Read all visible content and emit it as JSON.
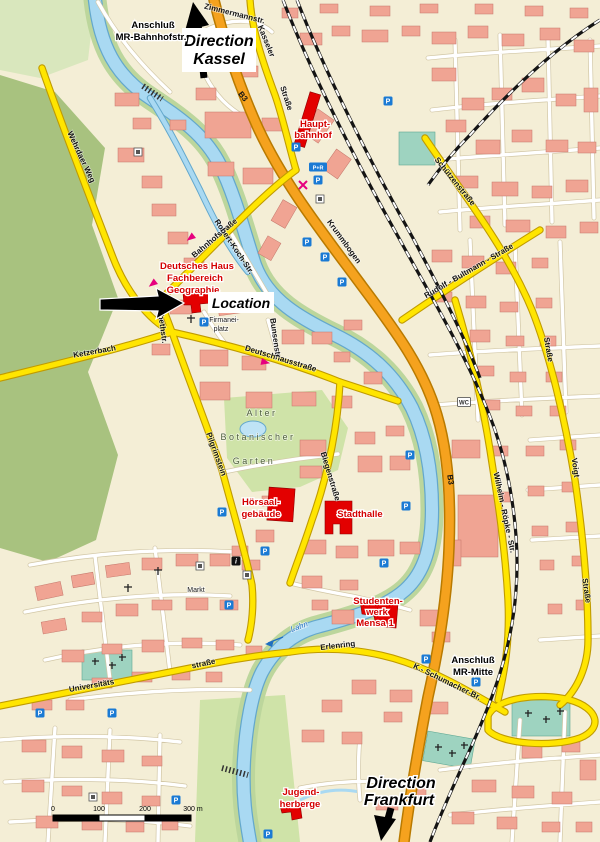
{
  "map": {
    "labels": {
      "direction_kassel": [
        "Direction",
        "Kassel"
      ],
      "direction_frankfurt": [
        "Direction",
        "Frankfurt"
      ],
      "anschluss_bahnhofstr": [
        "Anschluß",
        "MR-Bahnhofstr."
      ],
      "anschluss_mr_mitte": [
        "Anschluß",
        "MR-Mitte"
      ],
      "location": "Location"
    },
    "places": {
      "hauptbahnhof": [
        "Haupt-",
        "bahnhof"
      ],
      "deutsches_haus": [
        "Deutsches Haus",
        "Fachbereich",
        "Geographie"
      ],
      "firmaneiplatz": [
        "Firmanei-",
        "platz"
      ],
      "hoersaalgebaeude": [
        "Hörsaal-",
        "gebäude"
      ],
      "stadthalle": "Stadthalle",
      "studentenwerk_mensa": [
        "Studenten-",
        "werk",
        "Mensa 1"
      ],
      "jugendherberge": [
        "Jugend-",
        "herberge"
      ],
      "alter_botanischer_garten": [
        "Alter",
        "Botanischer",
        "Garten"
      ],
      "markt": "Markt",
      "lahn_river": "Lahn"
    },
    "streets": {
      "zimmermannstr": "Zimmermannstr.",
      "kasseler_1": "Kasseler",
      "kasseler_2": "Straße",
      "bahnhofstrasse": "Bahnhofstraße",
      "robert_koch_str": "Robert-Koch-Str.",
      "elisabethstr": "Elisabethstr.",
      "wehrdaer_weg": "Wehrdaer Weg",
      "ketzerbach": "Ketzerbach",
      "deutschhausstrasse": "Deutschhausstraße",
      "bunsenstr": "Bunsenstr.",
      "pilgrimstein": "Pilgrimstein",
      "biegenstrasse": "Biegenstraße",
      "krummbogen": "Krummbogen",
      "schuetzenstrasse": "Schützenstraße",
      "schuetzenstrasse_2": "Straße",
      "rudolf_bultmann_strasse": "Rudolf - Bultmann - Straße",
      "wilhelm_roepke_str": "Wilhelm - Röpke - Str.",
      "voigt_1": "Voigt",
      "voigt_2": "Straße",
      "universitaetsstrasse_1": "Universitäts",
      "universitaetsstrasse_2": "straße",
      "erlenring": "Erlenring",
      "schumacher": "K.- Schumacher-Br."
    },
    "road_refs": {
      "b3": "B3"
    },
    "badges": {
      "parking": "P",
      "park_and_ride": "P+R",
      "wc": "WC",
      "info": "i"
    },
    "scale_bar": {
      "tick_0": "0",
      "tick_100": "100",
      "tick_200": "200",
      "tick_300": "300 m"
    },
    "colors": {
      "building": "#f0a493",
      "landmark_red": "#e30000",
      "road_yellow": "#ffe500",
      "highway_orange": "#f5a21e",
      "water": "#a9d9f2",
      "park_green": "#cfe3a8",
      "forest_green": "#a8c27f",
      "cemetery_teal": "#9ed3c0",
      "parking_blue": "#1a7ad4",
      "place_label_red": "#d40000"
    }
  }
}
